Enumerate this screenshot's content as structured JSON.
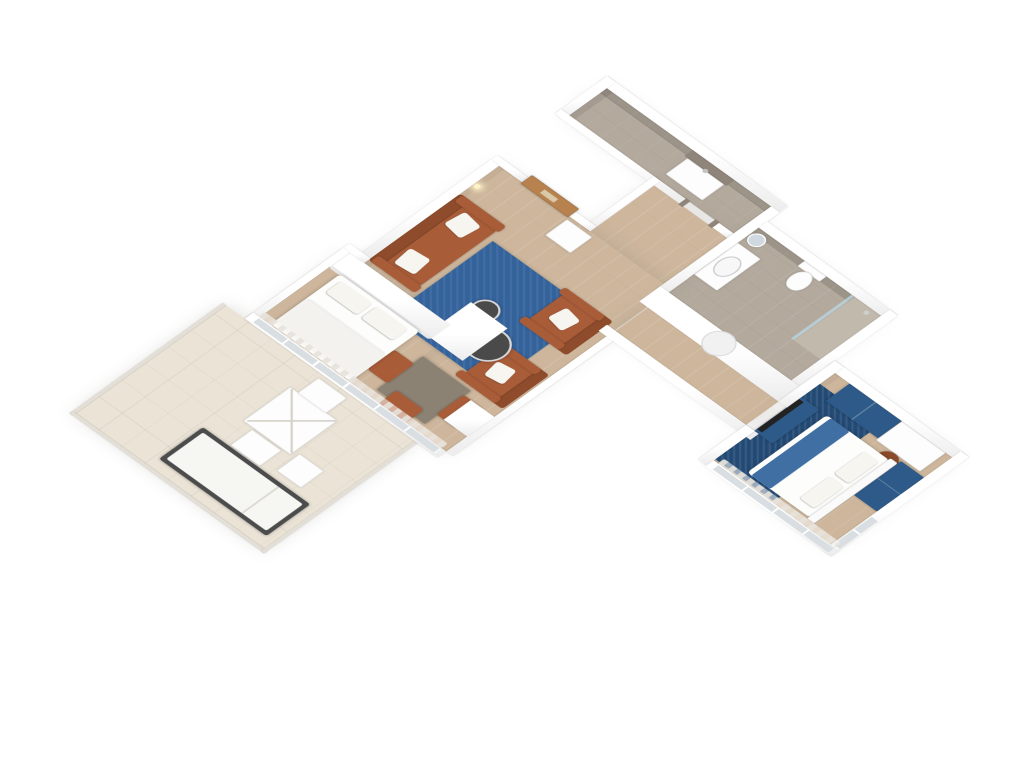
{
  "scene": {
    "label": "3D isometric floor plan render of a one-bedroom apartment with terrace",
    "view": "isometric",
    "background": "#ffffff"
  },
  "colors": {
    "wood": "#cdb69c",
    "tile": "#b3a99d",
    "tile-dark": "#9c9287",
    "terrace": "#eae3d6",
    "wall-shade": "#ececec",
    "leather": "#a85c38",
    "leather-dark": "#8e4c2c",
    "pillow": "#f7f5f0",
    "rug-living": "#34629b",
    "rug-bedroom": "#224a74",
    "blue-furn": "#2d5a88",
    "blue-runner": "#3f6fa3",
    "door-wood": "#b8824f",
    "door-window": "#d9c9a8",
    "glazing": "#d9dee3",
    "table-top": "#8b8273",
    "dark-table": "#4a4a4a",
    "lounger-frame": "#4c4c4c",
    "mirror": "#cfd9df",
    "doorway-dark": "#6b5f54",
    "niche": "#8f857a",
    "accent-glow": "#fff3c9",
    "picture": "#d8cfc0"
  },
  "rooms": [
    {
      "id": "bathroom-1",
      "label": "Shower room",
      "floor": "tile"
    },
    {
      "id": "bathroom-2",
      "label": "Bathroom",
      "floor": "tile"
    },
    {
      "id": "hallway",
      "label": "Entry hall",
      "floor": "wood"
    },
    {
      "id": "living-room",
      "label": "Living room",
      "floor": "wood"
    },
    {
      "id": "bedroom-alcove",
      "label": "Bedroom alcove",
      "floor": "wood"
    },
    {
      "id": "passage",
      "label": "Passage",
      "floor": "wood"
    },
    {
      "id": "bedroom-2",
      "label": "Bedroom",
      "floor": "wood"
    },
    {
      "id": "terrace",
      "label": "Terrace",
      "floor": "stone tile"
    }
  ],
  "furniture": [
    "entry-door",
    "side-table",
    "sofa",
    "armchair",
    "armchair",
    "blue-rug",
    "round-coffee-table-large",
    "round-coffee-table-small",
    "wall-picture",
    "wall-sconces",
    "murphy-bed-cabinet",
    "double-bed-white",
    "closet-block",
    "dining-table",
    "dining-chairs",
    "vanity-sink",
    "round-mirror",
    "wall-hung-toilet",
    "shower",
    "laundry-unit",
    "wall-niche",
    "circular-cutout-wall",
    "blue-wardrobes",
    "desk",
    "desk-chair",
    "tv-panel",
    "tv-dresser",
    "double-bed-blue-runner",
    "navy-rug",
    "terrace-table",
    "terrace-chairs",
    "sun-lounger",
    "railing"
  ]
}
